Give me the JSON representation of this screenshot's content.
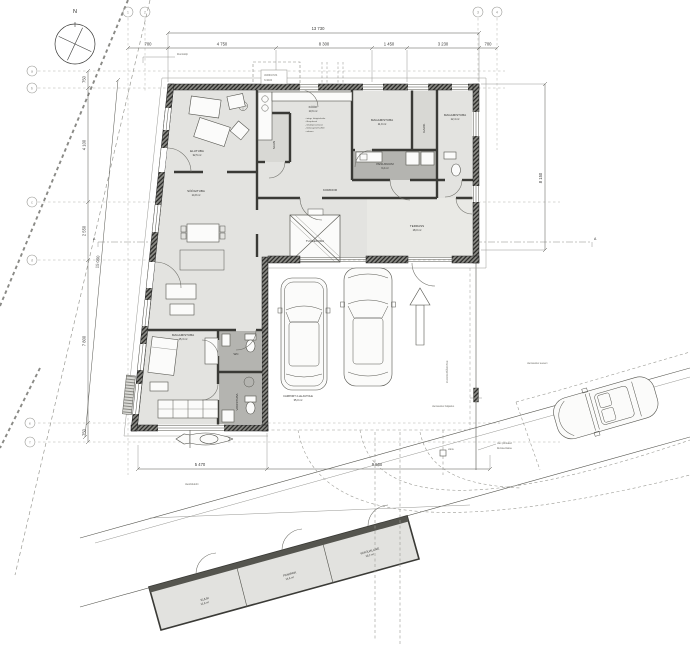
{
  "compass": {
    "north": "N"
  },
  "grid": {
    "cols": [
      "1",
      "2",
      "3",
      "4"
    ],
    "rows": [
      "a",
      "b",
      "c",
      "d",
      "e",
      "f"
    ]
  },
  "dims": {
    "top_total": "13 730",
    "top_segs": [
      "700",
      "4 750",
      "8 300",
      "1 450",
      "3 230",
      "700"
    ],
    "right_v": "8 150",
    "left_v": [
      "750",
      "4 100",
      "2 550",
      "7 800",
      "750"
    ],
    "left_slant": "15 050",
    "bottom": [
      "5 470",
      "9 560"
    ]
  },
  "rooms": {
    "living": {
      "name": "ELUTUBA",
      "area": "32,5 m²"
    },
    "dining": {
      "name": "SÖÖGITUBA",
      "area": "14,8 m²"
    },
    "kitchen": {
      "name": "KÖÖK",
      "area": "13,6 m²"
    },
    "kitchen_specs": [
      "- integr. köögitehnika",
      "- õhupuhasti",
      "- nõudepesumasin",
      "- töötasapind h=900",
      "- valamu"
    ],
    "bedroom1": {
      "name": "MAGAMISTUBA",
      "area": "11,9 m²"
    },
    "closet": {
      "name": "GARD."
    },
    "bedroom2": {
      "name": "MAGAMISTUBA",
      "area": "12,4 m²"
    },
    "washroom": {
      "name": "PESURUUM",
      "area": "6,2 m²"
    },
    "corridor": {
      "name": "KORIDOR"
    },
    "terrace": {
      "name": "TERRASS",
      "area": "18,0 m²"
    },
    "entry": {
      "name": "TUULEKODA"
    },
    "sauna": {
      "name": "SAUN"
    },
    "bedroom3": {
      "name": "MAGAMISTUBA",
      "area": "15,3 m²"
    },
    "wc2": {
      "name": "WC"
    },
    "bath": {
      "name": "VANNITUBA"
    },
    "carport": {
      "name": "CARPORT 2-LE AUTOLE",
      "area": "35,0 m²"
    },
    "shed1": {
      "name": "KUUR",
      "area": "12,8 m²"
    },
    "shed2": {
      "name": "PANIPAIK",
      "area": "14,6 m²"
    },
    "shed3": {
      "name": "VARJUALUNE",
      "area": "10,2 m²"
    }
  },
  "site": {
    "driveway": "JUURDEPÄÄSUTEE",
    "crossing": "ülesõidukoht",
    "road_edge": "olemasolev teeserv",
    "fence1": "olev piirdeaed",
    "fence2": "likvideeritakse",
    "note1": "olemasolev haljastus",
    "gate": "värav",
    "canopy1": "VARIKATUS",
    "canopy2": "h=2400",
    "junction": "liitumiskilp",
    "section": "A"
  }
}
